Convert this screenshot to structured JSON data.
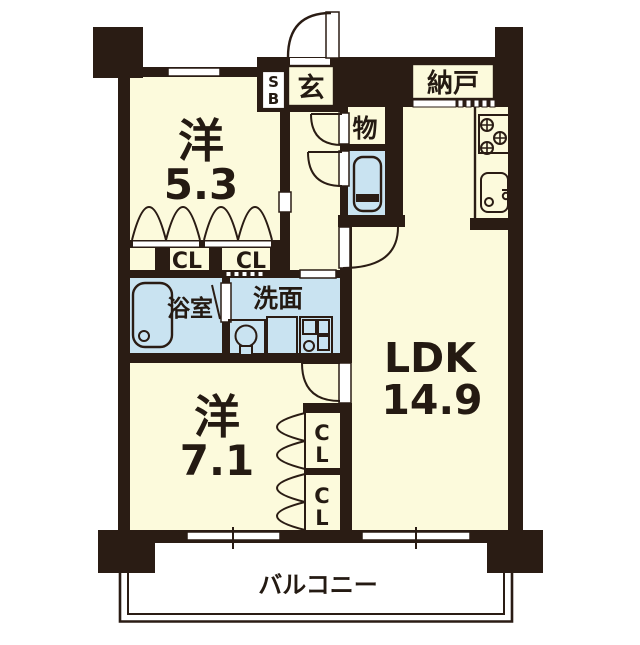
{
  "title": "apartment-floor-plan",
  "colors": {
    "wall": "#2A1C14",
    "room_fill": "#FCFADC",
    "wet_fill": "#C9E3F1",
    "background": "#FFFFFF"
  },
  "labels": {
    "western1_name": "洋",
    "western1_size": "5.3",
    "western2_name": "洋",
    "western2_size": "7.1",
    "ldk_name": "LDK",
    "ldk_size": "14.9",
    "entrance": "玄",
    "shoebox_s": "S",
    "shoebox_b": "B",
    "storage": "納戸",
    "small_closet": "物",
    "bath": "浴室",
    "washroom": "洗面",
    "closet1": "CL",
    "closet2": "CL",
    "closet3_c": "C",
    "closet3_l": "L",
    "closet4_c": "C",
    "closet4_l": "L",
    "balcony": "バルコニー"
  },
  "rooms": [
    {
      "label": "洋",
      "size": "5.3"
    },
    {
      "label": "洋",
      "size": "7.1"
    },
    {
      "label": "LDK",
      "size": "14.9"
    },
    {
      "label": "玄"
    },
    {
      "label": "SB"
    },
    {
      "label": "納戸"
    },
    {
      "label": "物"
    },
    {
      "label": "浴室"
    },
    {
      "label": "洗面"
    },
    {
      "label": "CL"
    },
    {
      "label": "CL"
    },
    {
      "label": "CL"
    },
    {
      "label": "CL"
    },
    {
      "label": "バルコニー"
    }
  ]
}
